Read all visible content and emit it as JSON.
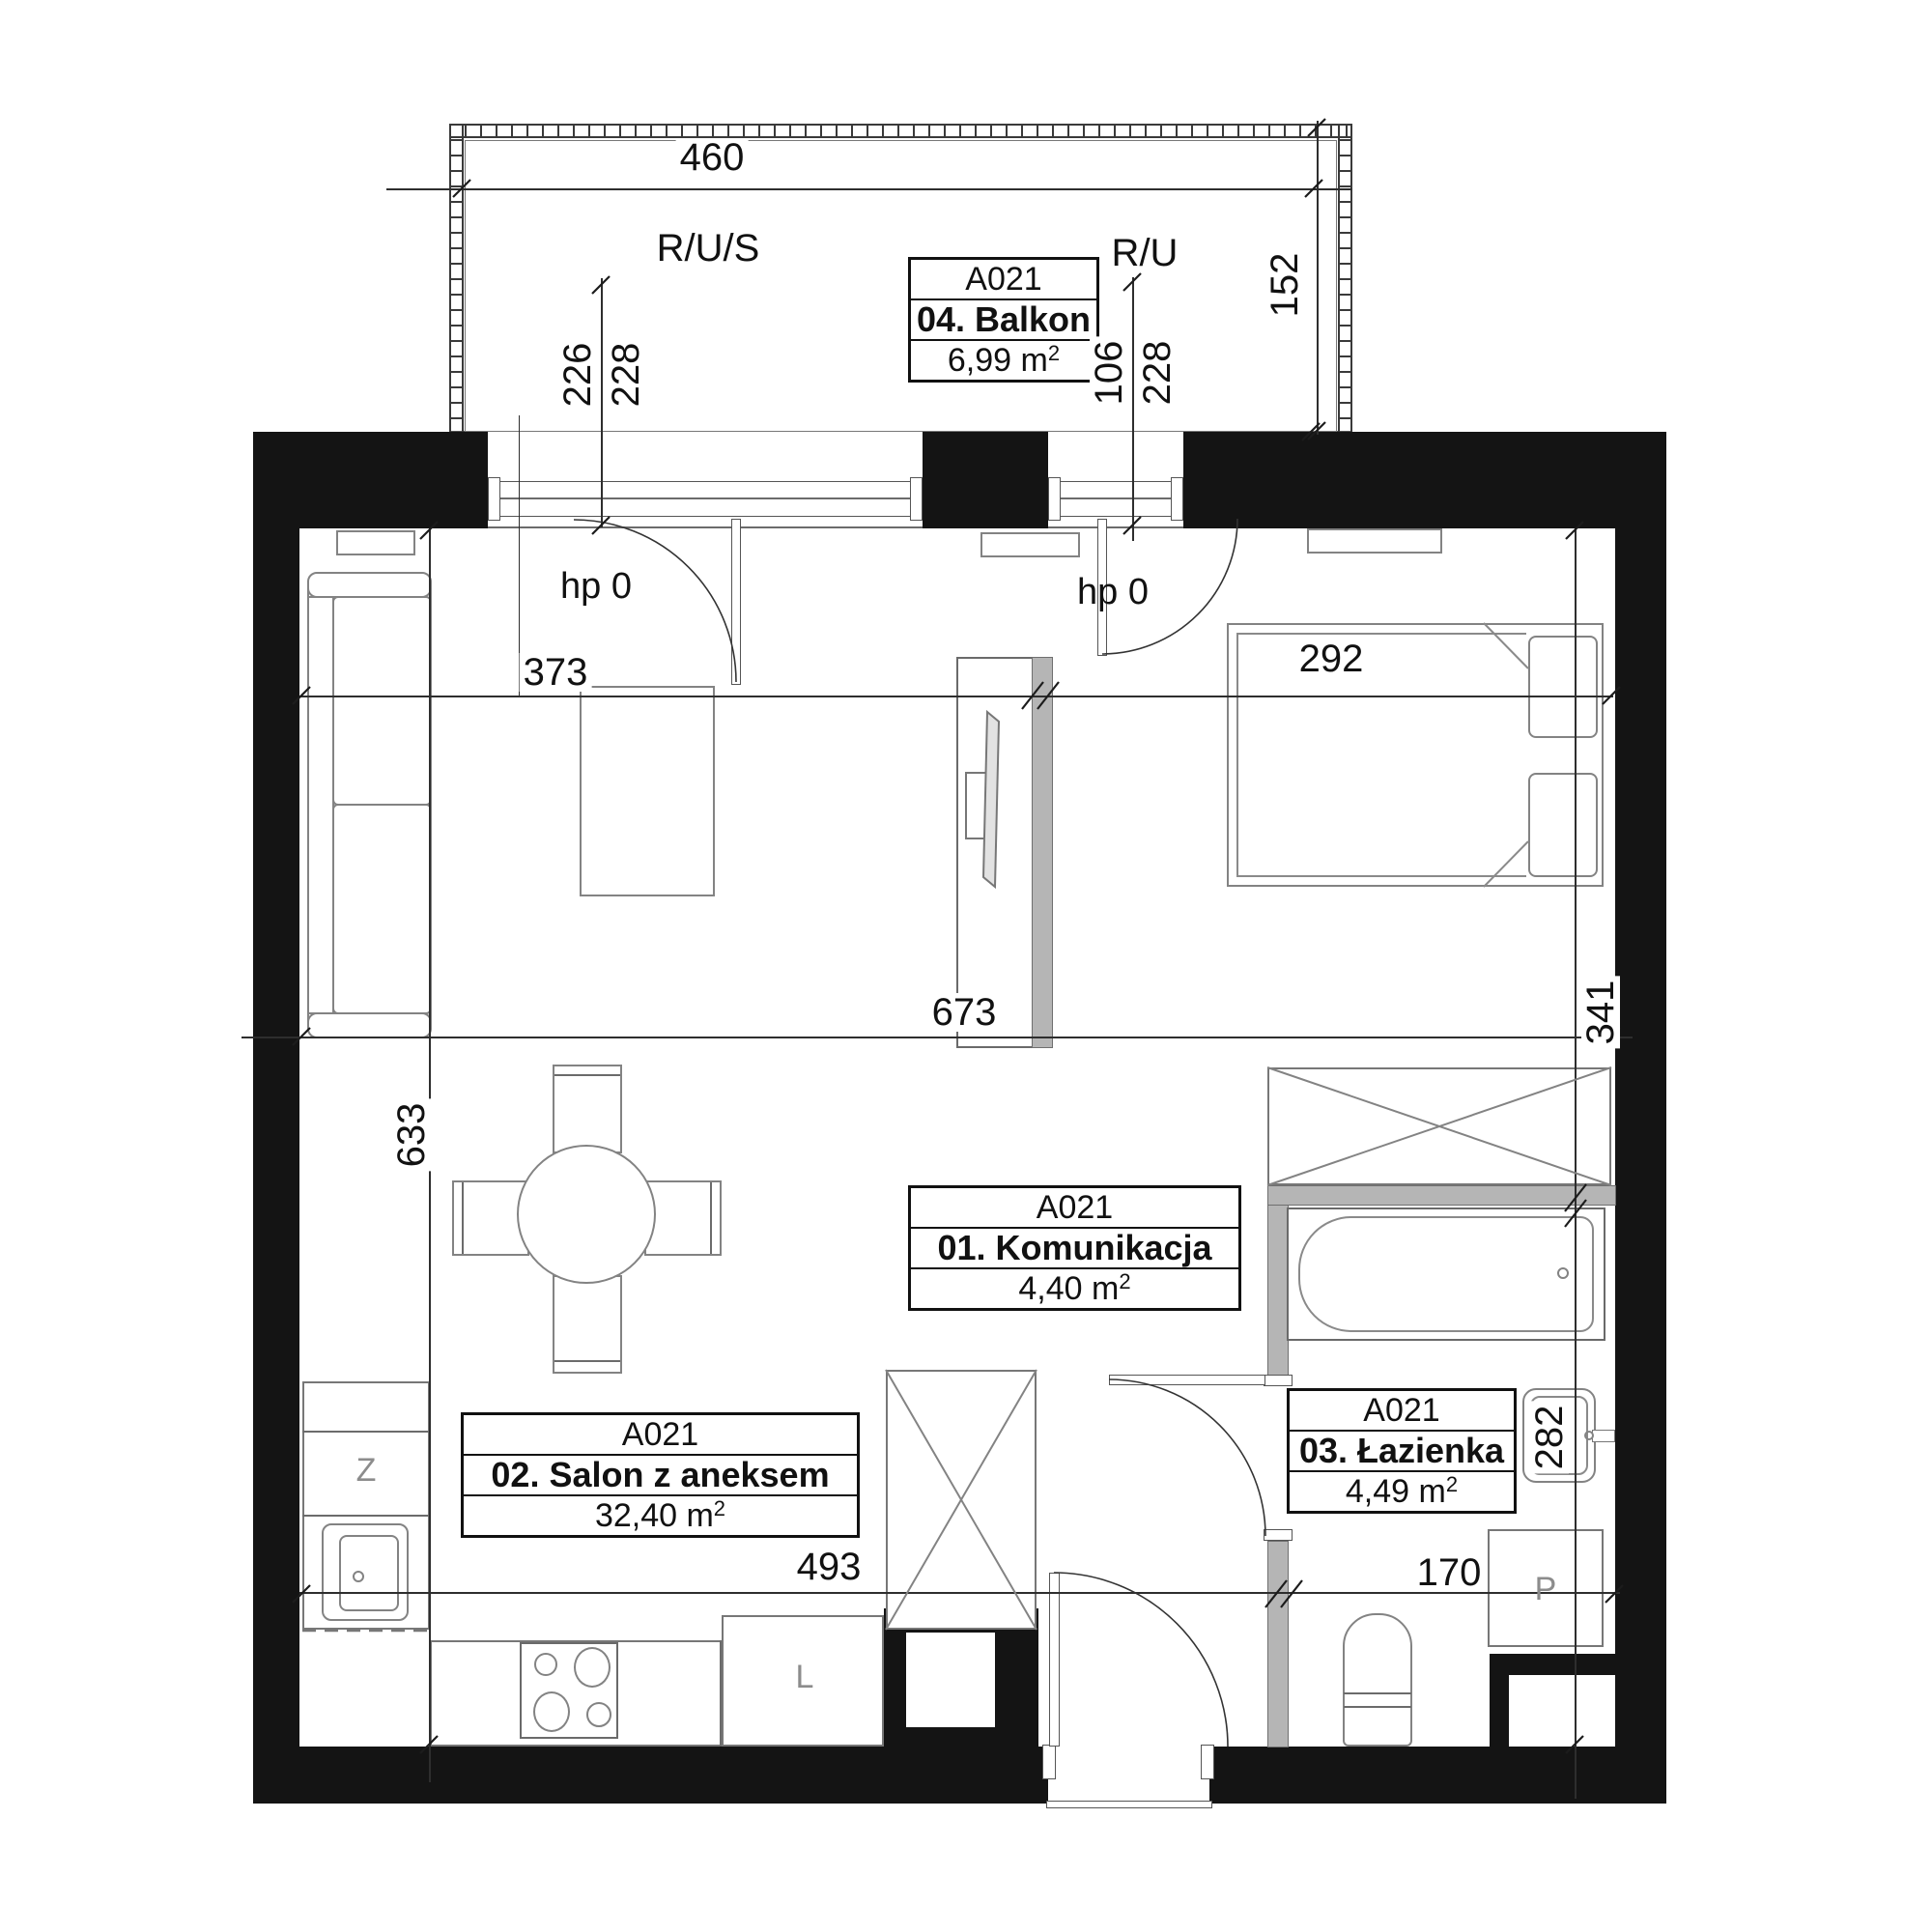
{
  "unit": "A021",
  "rooms": [
    {
      "unit": "A021",
      "name": "01. Komunikacja",
      "area": "4,40 m",
      "sup": "2"
    },
    {
      "unit": "A021",
      "name": "02. Salon z aneksem",
      "area": "32,40 m",
      "sup": "2"
    },
    {
      "unit": "A021",
      "name": "03. Łazienka",
      "area": "4,49 m",
      "sup": "2"
    },
    {
      "unit": "A021",
      "name": "04. Balkon",
      "area": "6,99 m",
      "sup": "2"
    }
  ],
  "annotations": {
    "riser_left": "R/U/S",
    "riser_right": "R/U",
    "hp_left": "hp 0",
    "hp_right": "hp 0"
  },
  "appliances": {
    "dishwasher": "Z",
    "fridge": "L",
    "washer": "P"
  },
  "dims": {
    "d460": "460",
    "d152": "152",
    "d226": "226",
    "d228l": "228",
    "d106": "106",
    "d228r": "228",
    "d373": "373",
    "d292": "292",
    "d673": "673",
    "d341": "341",
    "d633": "633",
    "d493": "493",
    "d170": "170",
    "d282": "282"
  }
}
